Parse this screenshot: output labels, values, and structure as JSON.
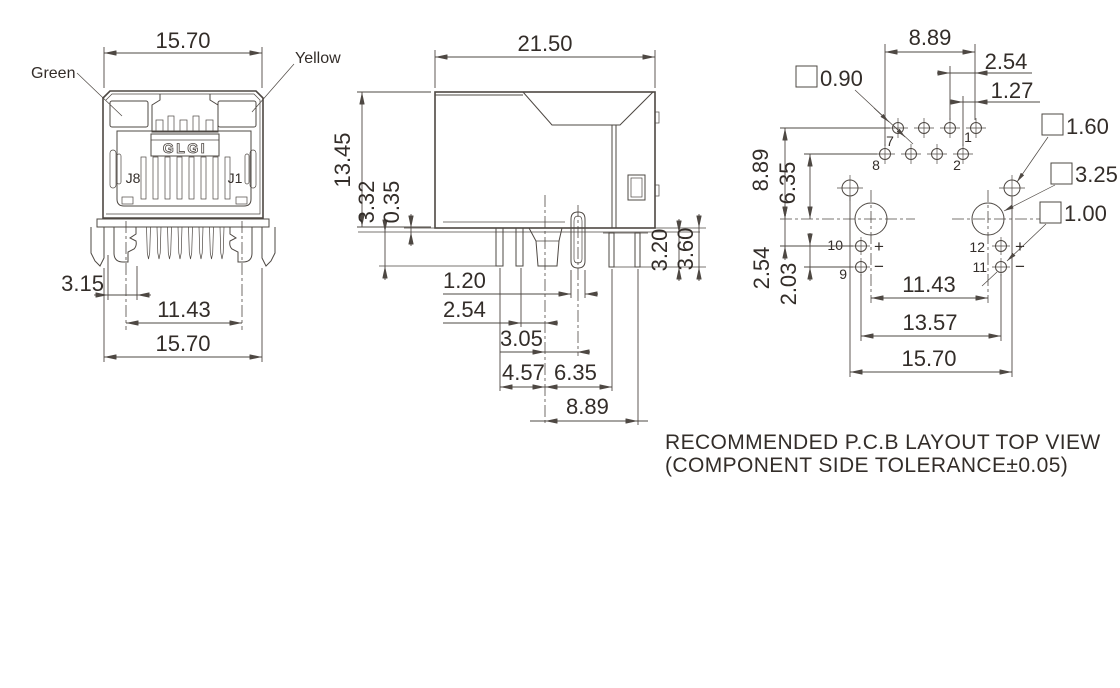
{
  "colors": {
    "background": "#ffffff",
    "line": "#4e4843",
    "text": "#332d29"
  },
  "front_view": {
    "led_left": "Green",
    "led_right": "Yellow",
    "brand": "GLGI",
    "jack_left": "J8",
    "jack_right": "J1",
    "dim_width_top": "15.70",
    "dim_post_offset": "3.15",
    "dim_post_spacing": "11.43",
    "dim_width_bottom": "15.70"
  },
  "side_view": {
    "dim_depth": "21.50",
    "dim_height": "13.45",
    "dim_post_length": "3.32",
    "dim_standoff": "0.35",
    "dim_tab_width": "1.20",
    "dim_post2_to_center": "2.54",
    "dim_center_to_tab": "3.05",
    "dim_post1_to_center": "4.57",
    "dim_center_to_pin1": "6.35",
    "dim_center_to_pin2": "8.89",
    "dim_pin_len_inner": "3.20",
    "dim_pin_len_outer": "3.60"
  },
  "pcb_view": {
    "dim_row_span": "8.89",
    "dim_pitch": "2.54",
    "dim_row_offset": "1.27",
    "hole_signal": "0.90",
    "hole_locator": "1.60",
    "hole_post": "3.25",
    "hole_led": "1.00",
    "dim_rows_to_post": "8.89",
    "dim_row2_to_post": "6.35",
    "dim_post_to_led": "2.54",
    "dim_led_pitch": "2.03",
    "dim_post_spacing": "11.43",
    "dim_led_spacing": "13.57",
    "dim_locator_spacing": "15.70",
    "pins": {
      "p1": "1",
      "p2": "2",
      "p7": "7",
      "p8": "8",
      "p9": "9",
      "p10": "10",
      "p11": "11",
      "p12": "12"
    },
    "plus": "+",
    "minus": "−",
    "note_line1": "RECOMMENDED P.C.B LAYOUT TOP VIEW",
    "note_line2": "(COMPONENT SIDE TOLERANCE±0.05)"
  }
}
